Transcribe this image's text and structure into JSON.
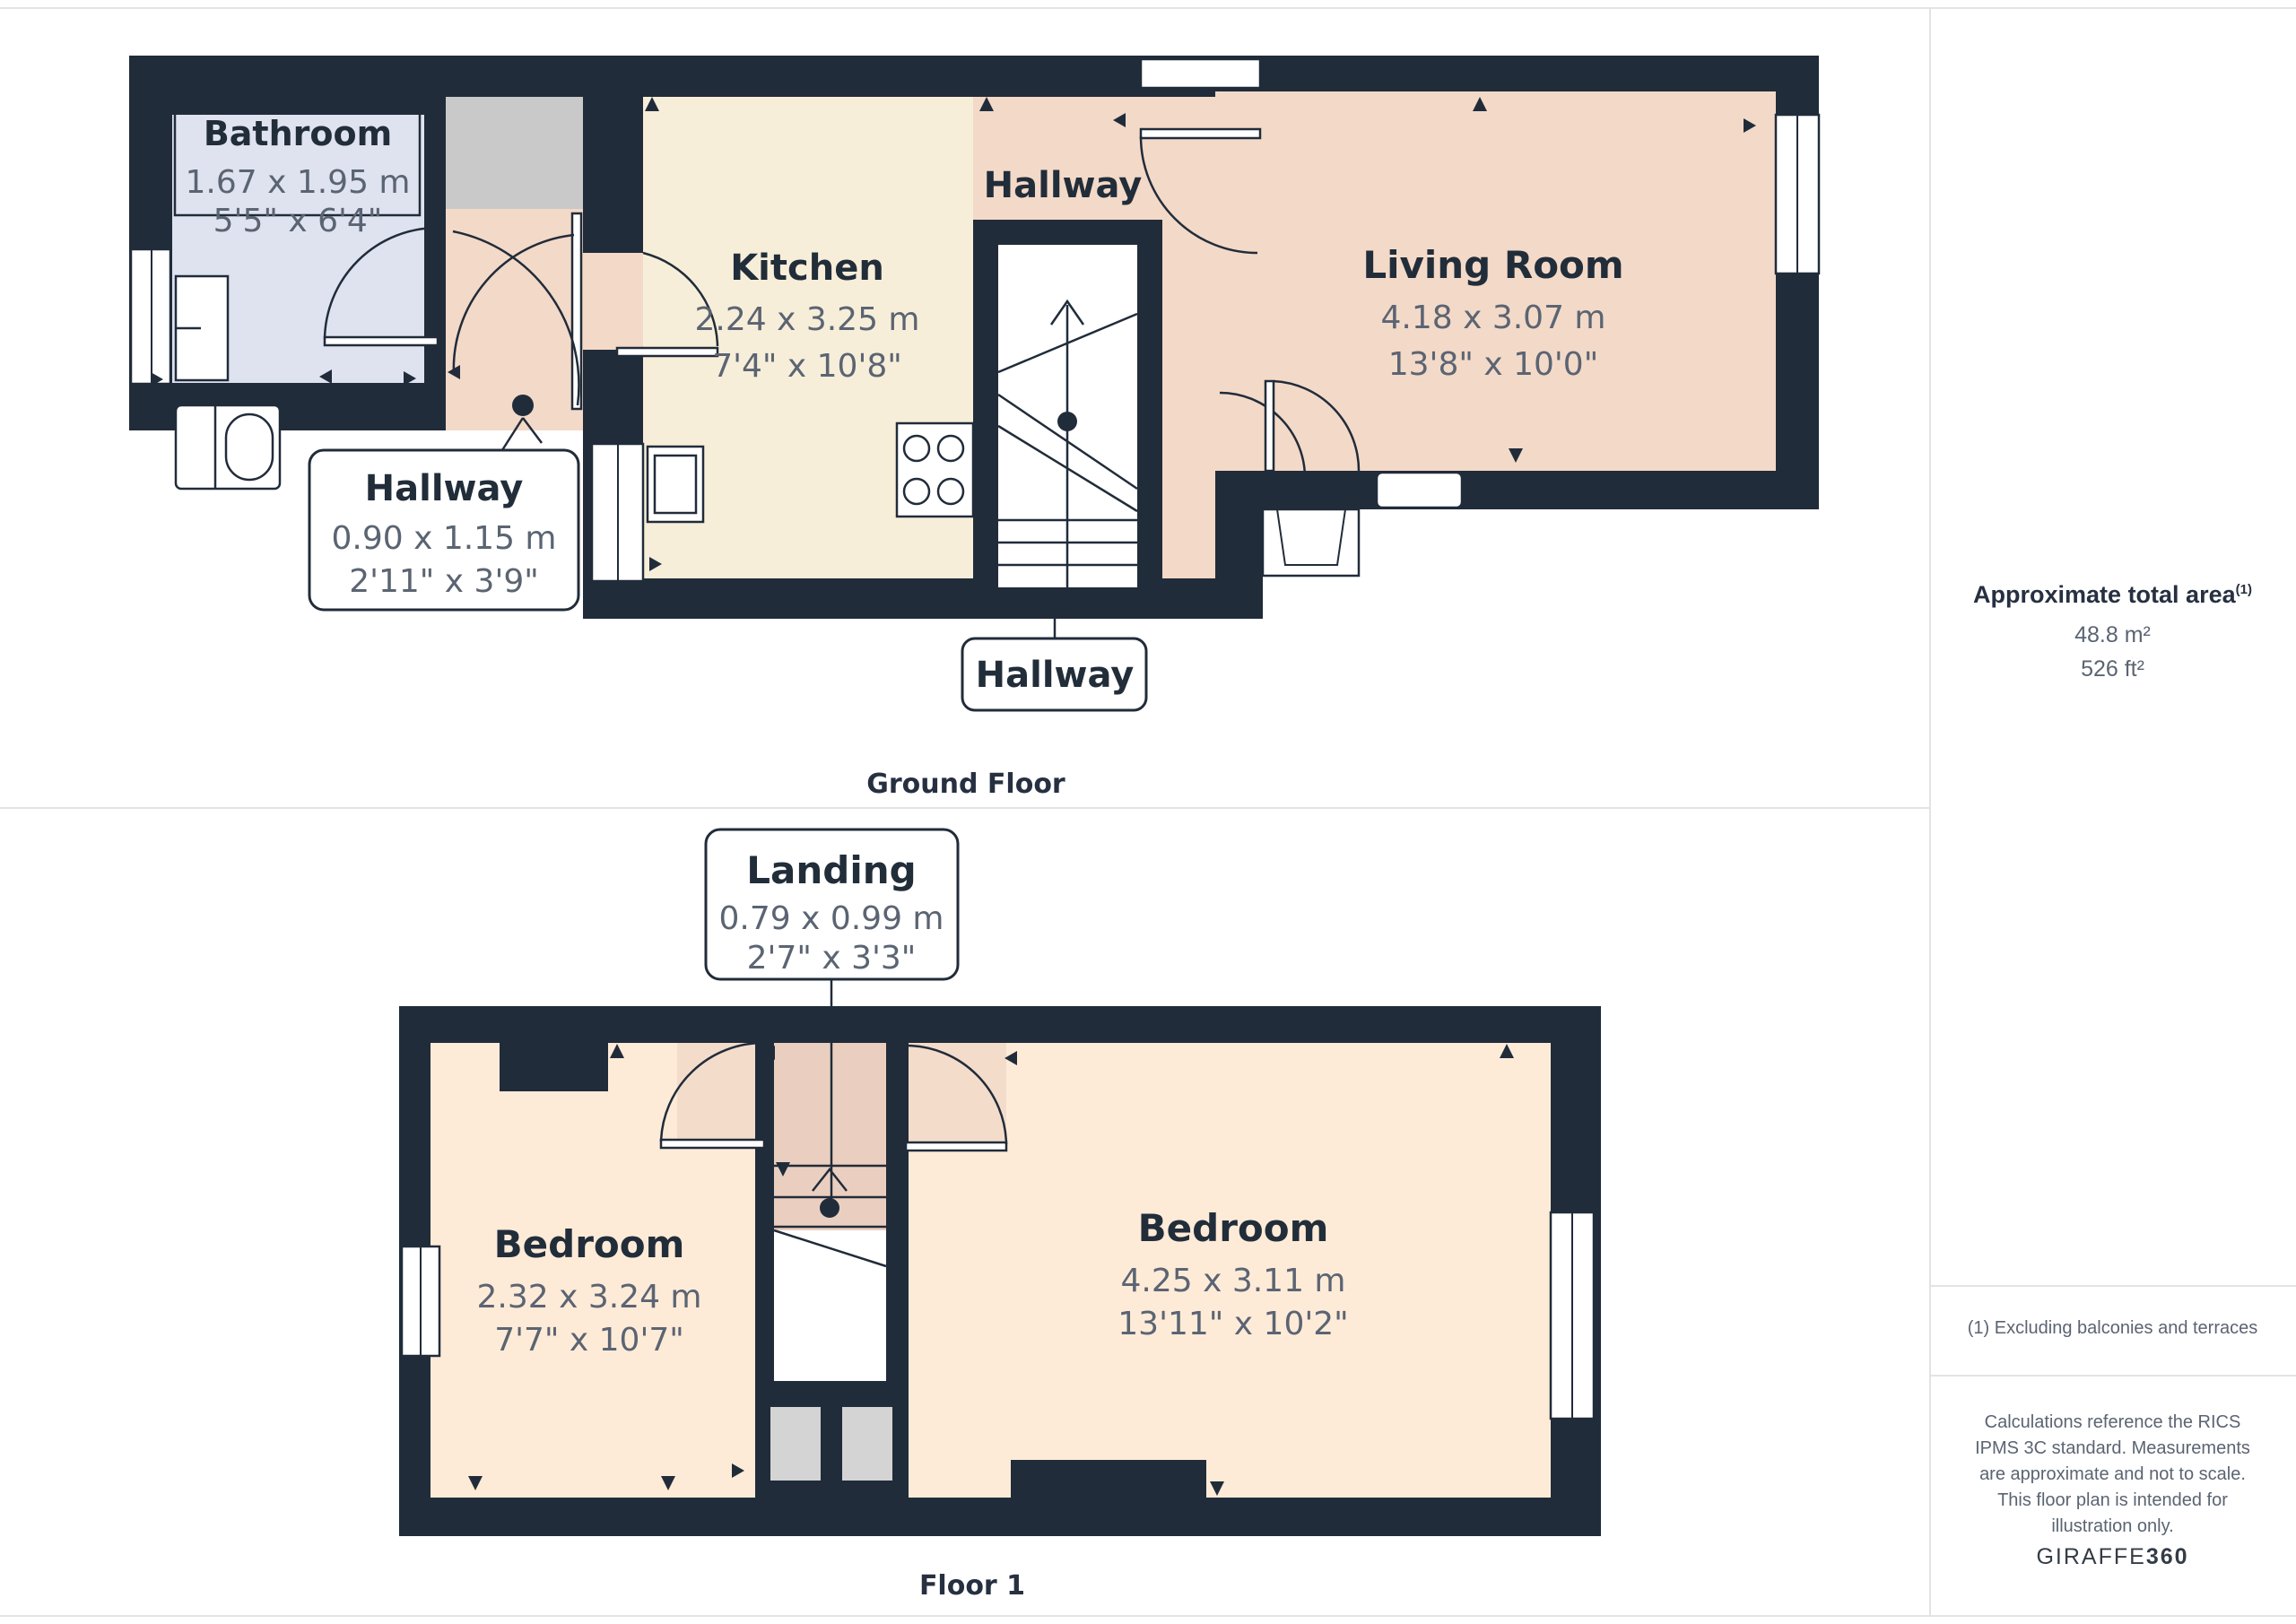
{
  "ground_floor": {
    "caption": "Ground Floor",
    "bathroom": {
      "name": "Bathroom",
      "metric": "1.67 x 1.95 m",
      "imperial": "5'5\" x 6'4\""
    },
    "kitchen": {
      "name": "Kitchen",
      "metric": "2.24 x 3.25 m",
      "imperial": "7'4\" x 10'8\""
    },
    "hallway_top": {
      "name": "Hallway"
    },
    "living_room": {
      "name": "Living Room",
      "metric": "4.18 x 3.07 m",
      "imperial": "13'8\" x 10'0\""
    },
    "hallway_callout": {
      "name": "Hallway",
      "metric": "0.90 x 1.15 m",
      "imperial": "2'11\" x 3'9\""
    },
    "hallway_callout_bottom": {
      "name": "Hallway"
    }
  },
  "floor_1": {
    "caption": "Floor 1",
    "landing_callout": {
      "name": "Landing",
      "metric": "0.79 x 0.99 m",
      "imperial": "2'7\" x 3'3\""
    },
    "bedroom_left": {
      "name": "Bedroom",
      "metric": "2.32 x 3.24 m",
      "imperial": "7'7\" x 10'7\""
    },
    "bedroom_right": {
      "name": "Bedroom",
      "metric": "4.25 x 3.11 m",
      "imperial": "13'11\" x 10'2\""
    }
  },
  "sidebar": {
    "area_title": "Approximate total area",
    "area_footnote_marker": "(1)",
    "area_metric": "48.8 m²",
    "area_imperial": "526 ft²",
    "footnote": "(1) Excluding balconies and terraces",
    "disclaimer": "Calculations reference the RICS IPMS 3C standard. Measurements are approximate and not to scale. This floor plan is intended for illustration only.",
    "brand_name": "GIRAFFE",
    "brand_number": "360"
  },
  "colors": {
    "wall": "#212c3a",
    "bathroom": "#dfe3f0",
    "kitchen": "#f7eed9",
    "hallway_pink": "#f3d9c8",
    "bedroom_peach": "#fdebd8",
    "landing_pink": "#eacfc0",
    "threshold_pink": "#f4dccb",
    "storage_grey": "#c8c9c8",
    "cupboard_grey": "#d4d4d4",
    "text_navy": "#222d3a",
    "text_grey": "#5b6472",
    "divider_grey": "#e3e3e3"
  }
}
